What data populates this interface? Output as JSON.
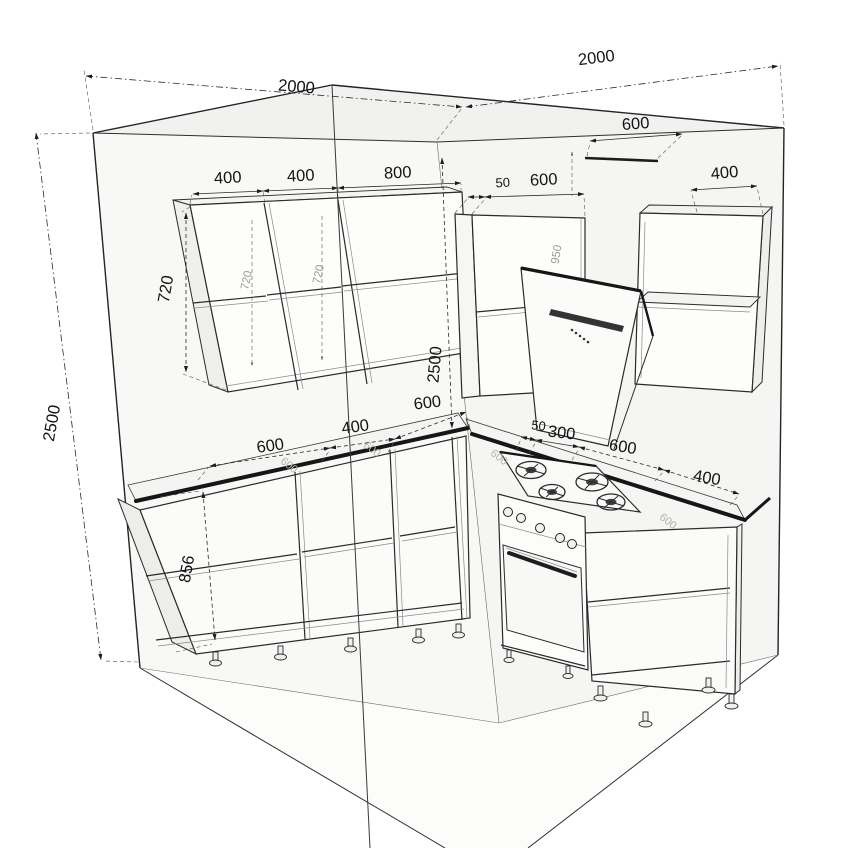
{
  "drawing": {
    "type": "kitchen-corner-technical-drawing",
    "colors": {
      "background": "#ffffff",
      "line": "#242424",
      "dimension": "#141414",
      "faint_label": "#9a9a9a",
      "wall_fill": "#f7f7f5",
      "ceiling_fill": "#f1f1ef",
      "floor_fill": "#fcfcfb",
      "counter_edge": "#161616"
    },
    "labels": {
      "wall_left_length": "2000",
      "wall_right_length": "2000",
      "wall_height": "2500",
      "upper_cab_1": "400",
      "upper_cab_2": "400",
      "upper_cab_3": "800",
      "upper_filler": "50",
      "upper_corner_cab": "600",
      "duct_width": "600",
      "upper_right_cab": "400",
      "upper_cab_height": "720",
      "corner_height": "2500",
      "corner_clearance": "600",
      "base_cab_1": "600",
      "base_cab_2": "400",
      "base_filler": "50",
      "stove_offset": "300",
      "stove_width": "600",
      "base_right_cab": "400",
      "base_height": "856",
      "hood_height": "950",
      "inner_height_1": "720",
      "inner_height_2": "720",
      "counter_depth_1": "600",
      "counter_depth_2": "600",
      "counter_depth_3": "600",
      "counter_depth_right": "600"
    }
  }
}
